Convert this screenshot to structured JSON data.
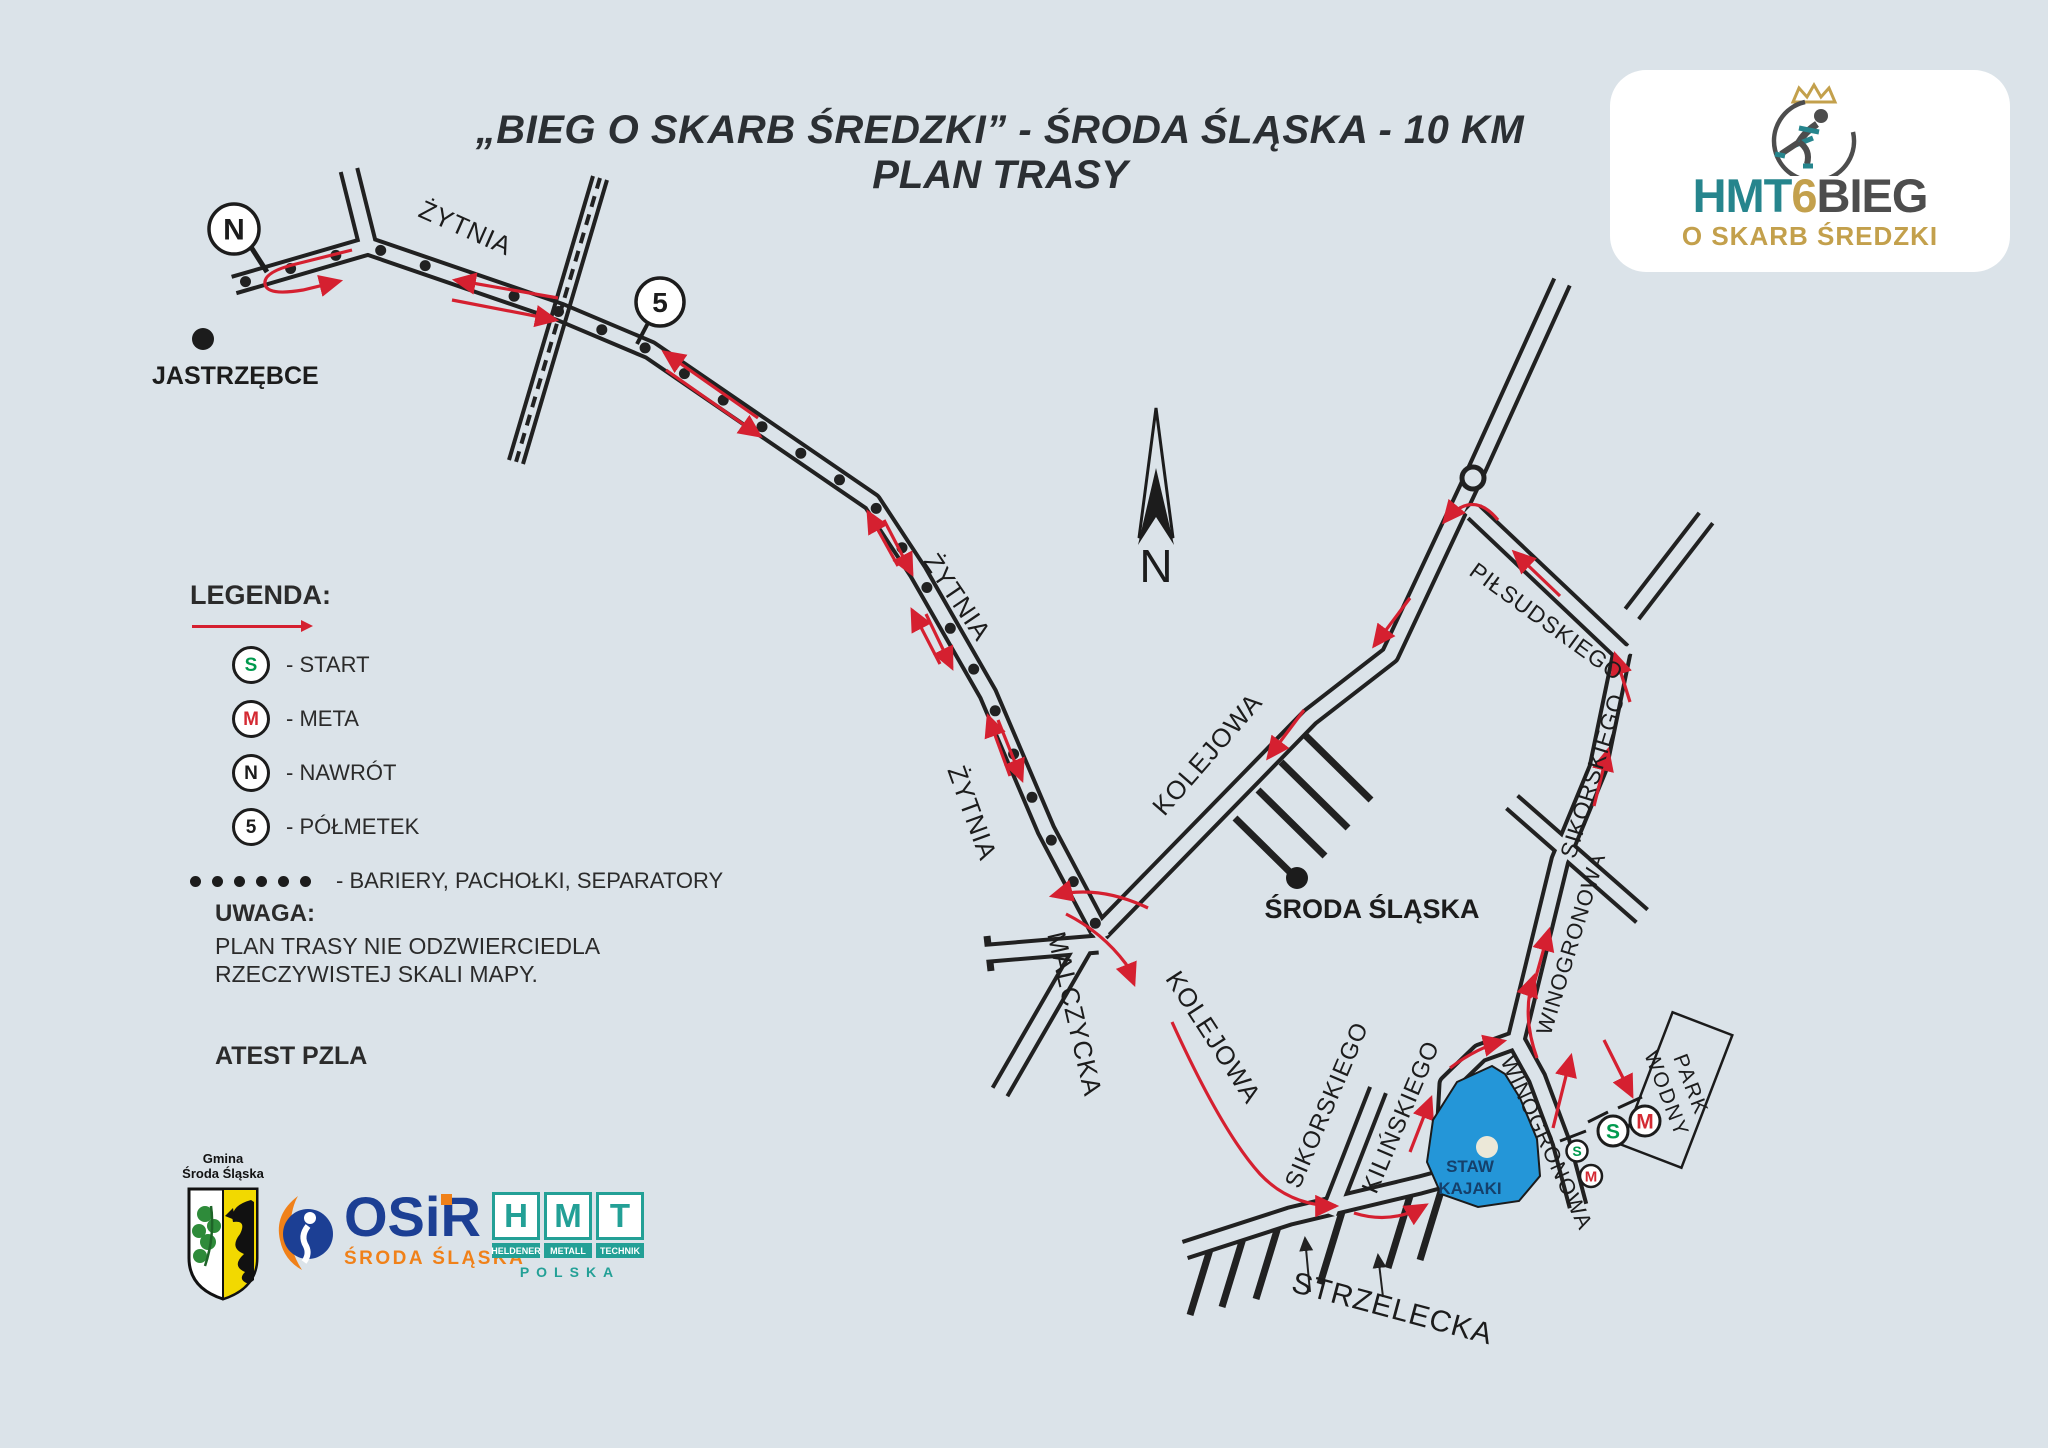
{
  "title": {
    "line1": "„BIEG O SKARB ŚREDZKI” - ŚRODA ŚLĄSKA - 10 KM",
    "line2": "PLAN TRASY"
  },
  "logo": {
    "hmt": "HMT",
    "six": "6",
    "bieg": "BIEG",
    "subtitle": "O SKARB ŚREDZKI"
  },
  "legend": {
    "heading": "LEGENDA:",
    "items": [
      {
        "symbol": "S",
        "color": "green",
        "label": "- START"
      },
      {
        "symbol": "M",
        "color": "red",
        "label": "- META"
      },
      {
        "symbol": "N",
        "color": "black",
        "label": "- NAWRÓT"
      },
      {
        "symbol": "5",
        "color": "black",
        "label": "- PÓŁMETEK"
      }
    ],
    "separators_label": "- BARIERY, PACHOŁKI, SEPARATORY"
  },
  "note": {
    "heading": "UWAGA:",
    "line1": "PLAN TRASY NIE ODZWIERCIEDLA",
    "line2": "RZECZYWISTEJ SKALI MAPY."
  },
  "attest": "ATEST PZLA",
  "compass": {
    "label": "N"
  },
  "sponsors": {
    "gmina": {
      "line1": "Gmina",
      "line2": "Środa Śląska"
    },
    "osir": {
      "name": "OSiR",
      "city": "ŚRODA ŚLĄSKA"
    },
    "hmt": {
      "letters": [
        "H",
        "M",
        "T"
      ],
      "words": [
        "HELDENER",
        "METALL",
        "TECHNIK"
      ],
      "country": "POLSKA"
    }
  },
  "colors": {
    "bg": "#dbe3e9",
    "road": "#212121",
    "route": "#d52030",
    "pond": "#2496d8",
    "pond_text": "#15406b",
    "island": "#ece8d8",
    "start_green": "#009a4e",
    "meta_red": "#d42a33",
    "ink": "#1c1c1c"
  },
  "map": {
    "towns": [
      {
        "name": "JASTRZĘBCE",
        "dot": [
          203,
          339
        ],
        "label_x": 152,
        "label_y": 384,
        "anchor": "start",
        "size": 25
      },
      {
        "name": "ŚRODA ŚLĄSKA",
        "dot": [
          1297,
          878
        ],
        "label_x": 1372,
        "label_y": 918,
        "anchor": "middle",
        "size": 27
      }
    ],
    "streets": [
      {
        "name": "zytnia-main",
        "pts": [
          [
            234,
            285
          ],
          [
            368,
            246
          ],
          [
            560,
            312
          ],
          [
            650,
            350
          ],
          [
            872,
            502
          ],
          [
            918,
            572
          ],
          [
            988,
            694
          ],
          [
            1046,
            830
          ],
          [
            1100,
            932
          ]
        ]
      },
      {
        "name": "zytnia-y-spur",
        "pts": [
          [
            368,
            246
          ],
          [
            349,
            170
          ]
        ]
      },
      {
        "name": "kolejowa-ne",
        "pts": [
          [
            1100,
            932
          ],
          [
            1310,
            717
          ],
          [
            1390,
            655
          ],
          [
            1473,
            478
          ]
        ]
      },
      {
        "name": "above-roundabout",
        "pts": [
          [
            1473,
            478
          ],
          [
            1562,
            282
          ]
        ]
      },
      {
        "name": "pilsudskiego",
        "pts": [
          [
            1474,
            512
          ],
          [
            1622,
            652
          ]
        ]
      },
      {
        "name": "sikorskiego-winogronowa",
        "pts": [
          [
            1622,
            652
          ],
          [
            1598,
            768
          ],
          [
            1560,
            860
          ],
          [
            1516,
            1040
          ]
        ]
      },
      {
        "name": "ne-corner-spur",
        "pts": [
          [
            1632,
            614
          ],
          [
            1706,
            518
          ]
        ]
      },
      {
        "name": "crossing-street",
        "pts": [
          [
            1512,
            802
          ],
          [
            1642,
            916
          ]
        ]
      },
      {
        "name": "strzelecka",
        "pts": [
          [
            1185,
            1250
          ],
          [
            1290,
            1216
          ],
          [
            1420,
            1185
          ],
          [
            1468,
            1172
          ]
        ]
      },
      {
        "name": "kilinskiego-wrap",
        "pts": [
          [
            1468,
            1172
          ],
          [
            1446,
            1120
          ],
          [
            1448,
            1084
          ],
          [
            1480,
            1053
          ],
          [
            1516,
            1040
          ]
        ]
      },
      {
        "name": "winogronowa-pond",
        "pts": [
          [
            1516,
            1040
          ],
          [
            1537,
            1078
          ],
          [
            1561,
            1142
          ],
          [
            1578,
            1206
          ]
        ]
      },
      {
        "name": "sikorskiego-lower",
        "pts": [
          [
            1332,
            1208
          ],
          [
            1378,
            1090
          ]
        ]
      },
      {
        "name": "malczycka",
        "pts": [
          [
            1082,
            950
          ],
          [
            1000,
            1092
          ]
        ]
      },
      {
        "name": "west-spur",
        "pts": [
          [
            1098,
            944
          ],
          [
            990,
            953
          ]
        ]
      }
    ],
    "singles": [
      [
        [
          987,
          936
        ],
        [
          991,
          971
        ]
      ],
      [
        [
          1235,
          818
        ],
        [
          1302,
          884
        ]
      ],
      [
        [
          1258,
          790
        ],
        [
          1325,
          856
        ]
      ],
      [
        [
          1281,
          762
        ],
        [
          1348,
          828
        ]
      ],
      [
        [
          1304,
          734
        ],
        [
          1371,
          800
        ]
      ],
      [
        [
          1212,
          1243
        ],
        [
          1190,
          1315
        ]
      ],
      [
        [
          1244,
          1235
        ],
        [
          1222,
          1307
        ]
      ],
      [
        [
          1278,
          1227
        ],
        [
          1256,
          1299
        ]
      ],
      [
        [
          1342,
          1212
        ],
        [
          1320,
          1284
        ]
      ],
      [
        [
          1410,
          1196
        ],
        [
          1388,
          1268
        ]
      ],
      [
        [
          1442,
          1188
        ],
        [
          1420,
          1260
        ]
      ]
    ],
    "railroad": {
      "rail1": [
        [
          593,
          176
        ],
        [
          509,
          460
        ]
      ],
      "rail2": [
        [
          607,
          180
        ],
        [
          523,
          464
        ]
      ],
      "dash": [
        [
          600,
          178
        ],
        [
          516,
          462
        ]
      ]
    },
    "dots": {
      "along": "zytnia-main",
      "spacing": 47,
      "radius": 5.5
    },
    "route_arrows": [
      "M 352,250 L 296,264 Q 263,272 265,284 Q 267,296 303,290 L 340,281",
      "M 558,298 L 455,280",
      "M 452,300 L 556,320",
      "M 758,418 L 664,352",
      "M 666,370 L 760,436",
      "M 898,566 L 868,512",
      "M 884,520 L 912,574",
      "M 940,664 L 912,610",
      "M 926,614 L 952,668",
      "M 1010,776 L 988,716",
      "M 998,720 L 1022,780",
      "M 1148,908 Q 1098,884 1052,896",
      "M 1066,914 Q 1102,932 1126,964 L 1134,984",
      "M 1410,598 L 1374,646",
      "M 1304,710 L 1268,758",
      "M 1498,520 Q 1472,488 1444,522",
      "M 1560,596 L 1514,552",
      "M 1630,702 L 1615,654",
      "M 1594,806 L 1608,750",
      "M 1530,998 L 1549,930",
      "M 1450,1068 Q 1478,1047 1504,1041",
      "M 1537,1058 Q 1521,1014 1534,976",
      "M 1553,1128 L 1571,1056",
      "M 1604,1040 L 1632,1096",
      "M 1172,1022 Q 1222,1132 1260,1174 Q 1290,1206 1336,1206",
      "M 1354,1213 Q 1392,1225 1426,1205",
      "M 1410,1152 L 1431,1098"
    ],
    "minor_arrows": [
      "M 1310,1292 L 1305,1238",
      "M 1383,1297 L 1378,1255"
    ],
    "street_labels": [
      {
        "text": "ŻYTNIA",
        "x": 462,
        "y": 236,
        "rot": 24,
        "size": 26
      },
      {
        "text": "ŻYTNIA",
        "x": 950,
        "y": 602,
        "rot": 56,
        "size": 26
      },
      {
        "text": "ŻYTNIA",
        "x": 964,
        "y": 816,
        "rot": 70,
        "size": 26
      },
      {
        "text": "KOLEJOWA",
        "x": 1214,
        "y": 760,
        "rot": -49,
        "size": 26
      },
      {
        "text": "KOLEJOWA",
        "x": 1206,
        "y": 1042,
        "rot": 57,
        "size": 26
      },
      {
        "text": "MALCZYCKA",
        "x": 1066,
        "y": 1016,
        "rot": 77,
        "size": 26
      },
      {
        "text": "SIKORSKIEGO",
        "x": 1334,
        "y": 1108,
        "rot": -67,
        "size": 24
      },
      {
        "text": "KILIŃSKIEGO",
        "x": 1408,
        "y": 1120,
        "rot": -67,
        "size": 24
      },
      {
        "text": "SIKORSKIEGO",
        "x": 1600,
        "y": 778,
        "rot": -73,
        "size": 23
      },
      {
        "text": "WINOGRONOWA",
        "x": 1578,
        "y": 946,
        "rot": -73,
        "size": 22
      },
      {
        "text": "WINOGRONOWA",
        "x": 1540,
        "y": 1146,
        "rot": 65,
        "size": 22
      },
      {
        "text": "PIŁSUDSKIEGO",
        "x": 1542,
        "y": 628,
        "rot": 36,
        "size": 23
      },
      {
        "text": "STRZELECKA",
        "x": 1390,
        "y": 1318,
        "rot": 15,
        "size": 30
      }
    ],
    "markers": {
      "nawrot": {
        "cx": 234,
        "cy": 229,
        "r": 25,
        "text": "N",
        "leader": [
          [
            251,
            247
          ],
          [
            267,
            272
          ]
        ]
      },
      "polmetek": {
        "cx": 660,
        "cy": 302,
        "r": 24,
        "text": "5",
        "leader": [
          [
            648,
            323
          ],
          [
            637,
            344
          ]
        ]
      },
      "roundabout": {
        "cx": 1473,
        "cy": 478,
        "r": 11
      },
      "start_small": {
        "cx": 1577,
        "cy": 1151,
        "r": 10.5,
        "text": "S",
        "size": 14
      },
      "meta_small": {
        "cx": 1591,
        "cy": 1176,
        "r": 11,
        "text": "M",
        "size": 15
      },
      "start_big": {
        "cx": 1613,
        "cy": 1131,
        "r": 15,
        "text": "S",
        "size": 21
      },
      "meta_big": {
        "cx": 1645,
        "cy": 1121,
        "r": 15,
        "text": "M",
        "size": 21
      },
      "gates": [
        [
          [
            1560,
            1141
          ],
          [
            1586,
            1131
          ]
        ],
        [
          [
            1588,
            1122
          ],
          [
            1608,
            1112
          ]
        ],
        [
          [
            1618,
            1108
          ],
          [
            1642,
            1097
          ]
        ]
      ]
    },
    "pond": {
      "poly": [
        [
          1492,
          1066
        ],
        [
          1457,
          1082
        ],
        [
          1433,
          1120
        ],
        [
          1427,
          1162
        ],
        [
          1441,
          1194
        ],
        [
          1478,
          1207
        ],
        [
          1519,
          1201
        ],
        [
          1540,
          1176
        ],
        [
          1537,
          1139
        ],
        [
          1520,
          1098
        ],
        [
          1505,
          1074
        ]
      ],
      "island": {
        "cx": 1487,
        "cy": 1147,
        "r": 11
      },
      "label1": "STAW",
      "label2": "KAJAKI",
      "lx": 1470,
      "ly1": 1172,
      "ly2": 1194
    },
    "park": {
      "cx": 1677,
      "cy": 1090,
      "w": 64,
      "h": 142,
      "rot": 21,
      "text_rot": 69,
      "label1": "PARK",
      "label2": "WODNY"
    },
    "compass": {
      "outline": [
        [
          1156,
          408
        ],
        [
          1139,
          538
        ],
        [
          1156,
          512
        ],
        [
          1173,
          538
        ]
      ],
      "fill": [
        [
          1156,
          468
        ],
        [
          1138,
          545
        ],
        [
          1156,
          517
        ],
        [
          1174,
          545
        ]
      ],
      "nx": 1156,
      "ny": 582
    }
  }
}
